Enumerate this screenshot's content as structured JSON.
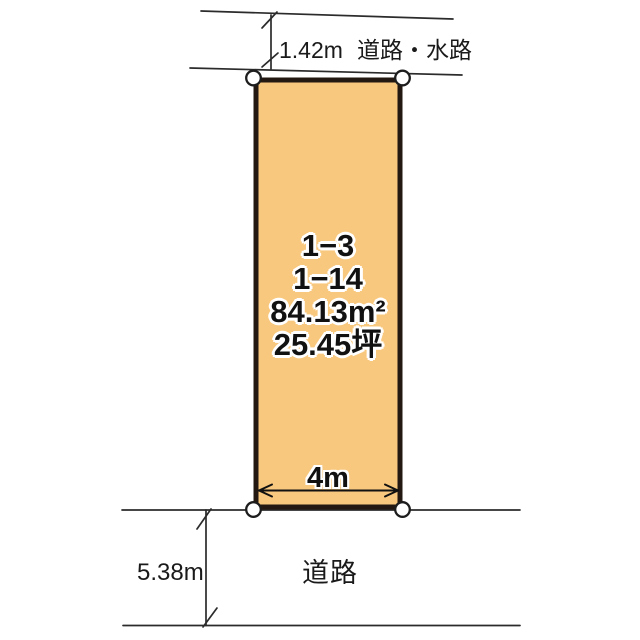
{
  "diagram": {
    "title": "land-plot-layout",
    "top_road": {
      "distance": "1.42m",
      "label": "道路・水路"
    },
    "plot": {
      "lot_number_1": "1−3",
      "lot_number_2": "1−14",
      "area_m2": "84.13m²",
      "area_tsubo": "25.45坪",
      "frontage": "4m"
    },
    "bottom_road": {
      "distance": "5.38m",
      "label": "道路"
    },
    "colors": {
      "plot_fill": "#F8C87E",
      "plot_border": "#241812",
      "line_color": "#2b2b2b",
      "corner_marker_fill": "#ffffff"
    }
  }
}
